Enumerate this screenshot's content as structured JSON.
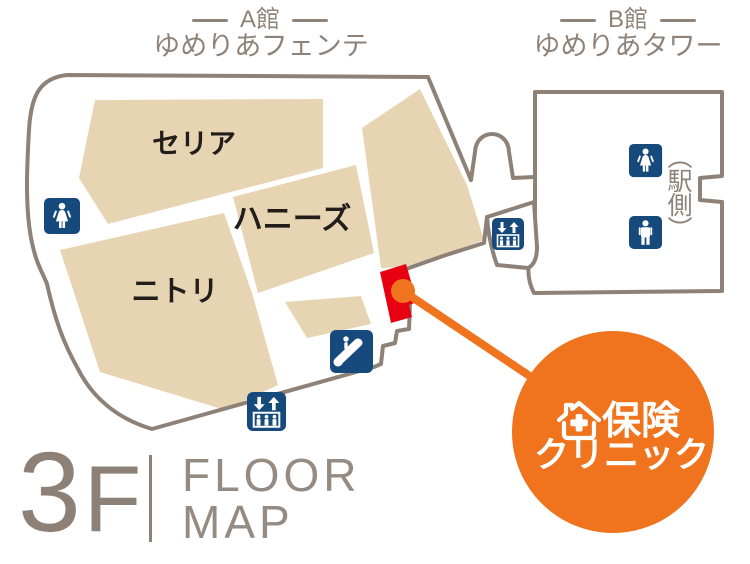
{
  "header": {
    "building_a": {
      "title": "A館",
      "subtitle": "ゆめりあフェンテ"
    },
    "building_b": {
      "title": "B館",
      "subtitle": "ゆめりあタワー"
    }
  },
  "stores": {
    "seria": "セリア",
    "honeys": "ハニーズ",
    "nitori": "ニトリ"
  },
  "annotations": {
    "station_side": "（駅側）"
  },
  "callout": {
    "line1": "保険",
    "line2": "クリニック"
  },
  "floor": {
    "number": "3",
    "suffix": "F",
    "word1": "FLOOR",
    "word2": "MAP"
  },
  "icons": {
    "restroom_female": "woman-figure",
    "restroom_male": "man-figure",
    "elevator": "up-down-arrows-over-people-in-box",
    "escalator": "person-on-diagonal-escalator",
    "clinic_logo": "house-with-plus-cross"
  },
  "colors": {
    "block_beige": "#e7d4b2",
    "outline_taupe": "#8e8177",
    "icon_navy": "#174a7c",
    "marker_red": "#e60012",
    "accent_orange": "#f0741e",
    "store_text": "#221d1a",
    "header_text": "#8f8379"
  }
}
